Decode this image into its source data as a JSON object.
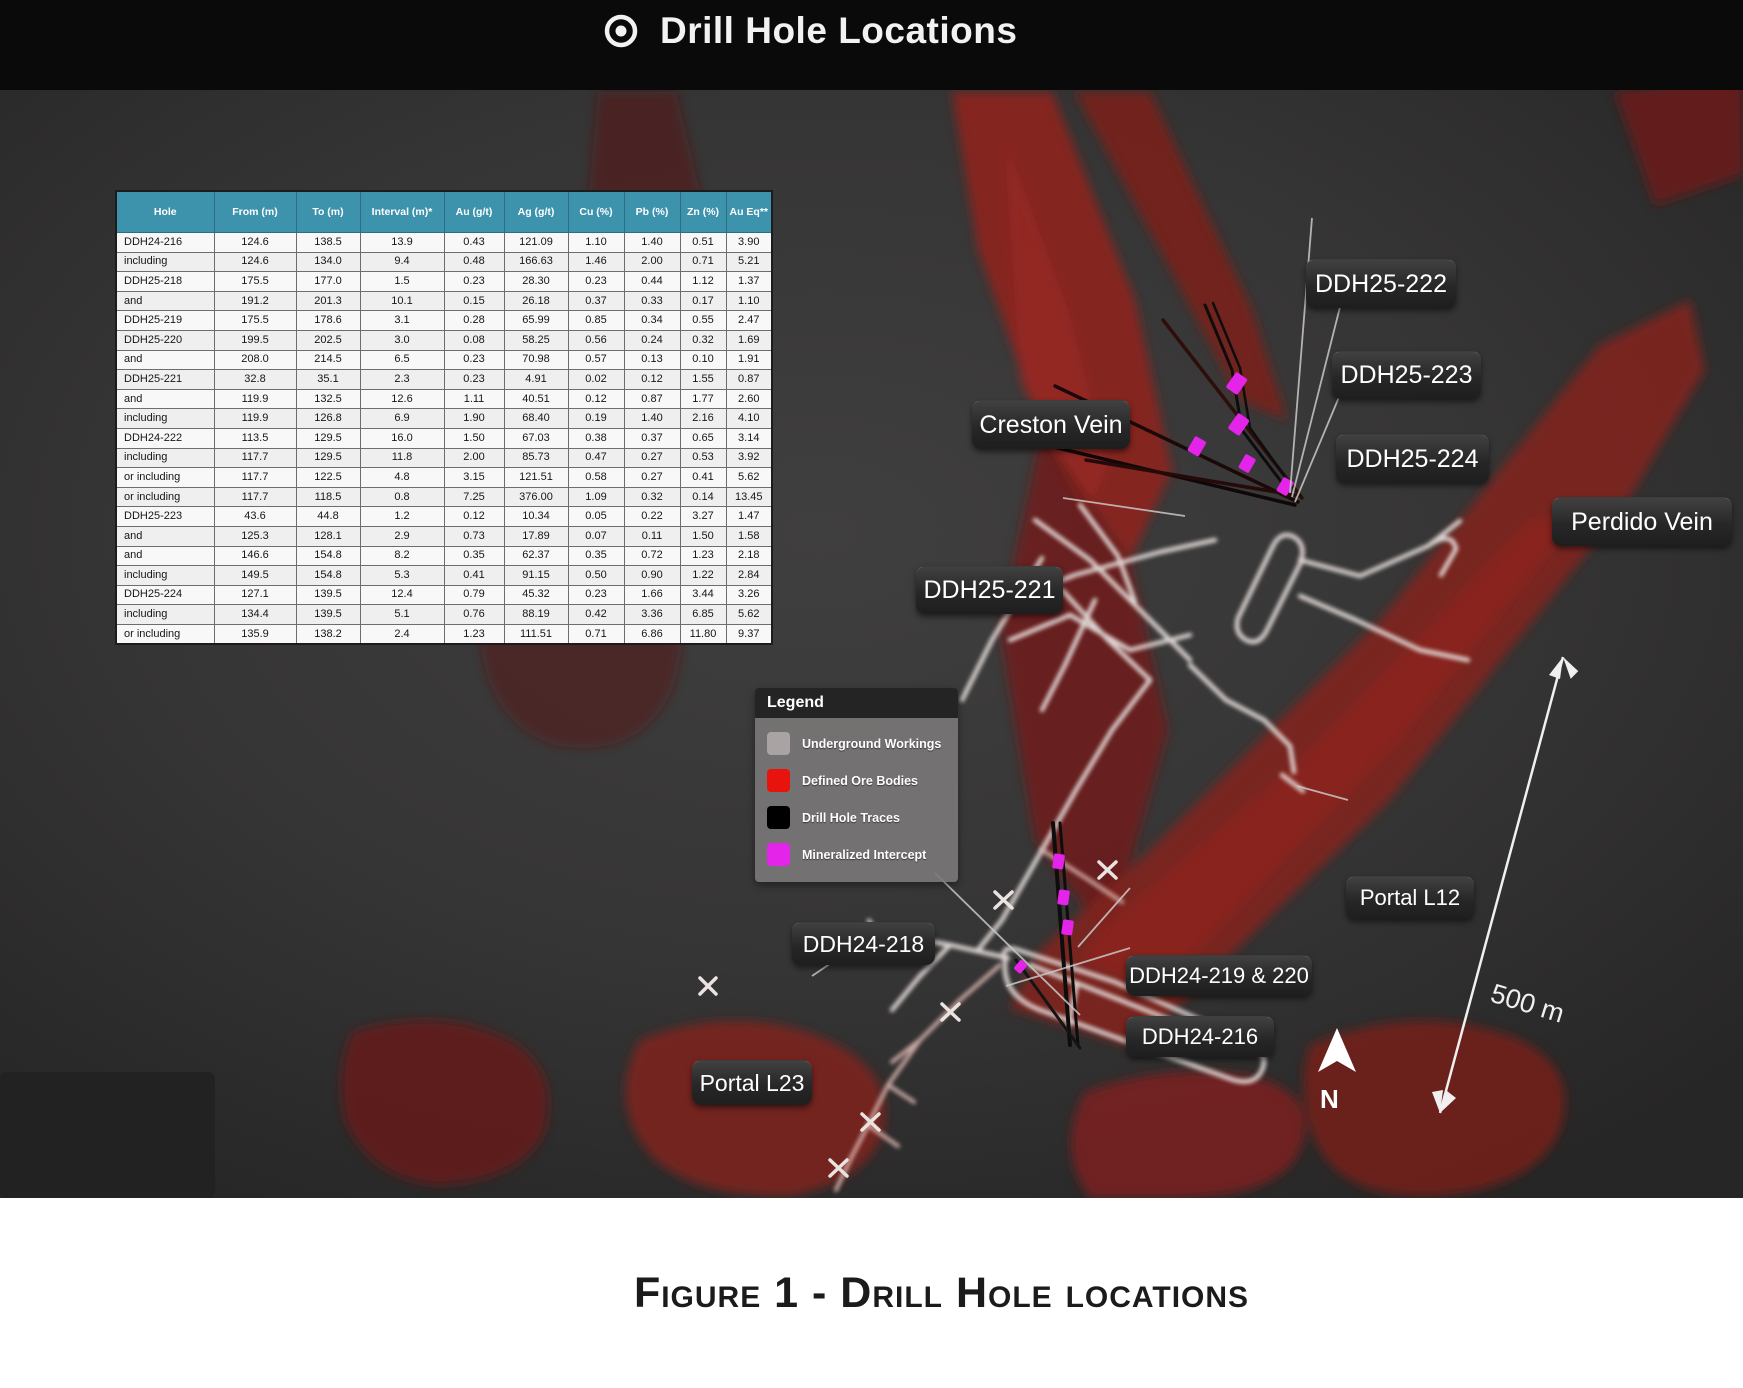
{
  "header": {
    "title": "Drill Hole Locations"
  },
  "table": {
    "columns": [
      "Hole",
      "From (m)",
      "To (m)",
      "Interval (m)*",
      "Au (g/t)",
      "Ag (g/t)",
      "Cu (%)",
      "Pb (%)",
      "Zn (%)",
      "Au Eq**"
    ],
    "rows": [
      [
        "DDH24-216",
        "124.6",
        "138.5",
        "13.9",
        "0.43",
        "121.09",
        "1.10",
        "1.40",
        "0.51",
        "3.90"
      ],
      [
        "including",
        "124.6",
        "134.0",
        "9.4",
        "0.48",
        "166.63",
        "1.46",
        "2.00",
        "0.71",
        "5.21"
      ],
      [
        "DDH25-218",
        "175.5",
        "177.0",
        "1.5",
        "0.23",
        "28.30",
        "0.23",
        "0.44",
        "1.12",
        "1.37"
      ],
      [
        "and",
        "191.2",
        "201.3",
        "10.1",
        "0.15",
        "26.18",
        "0.37",
        "0.33",
        "0.17",
        "1.10"
      ],
      [
        "DDH25-219",
        "175.5",
        "178.6",
        "3.1",
        "0.28",
        "65.99",
        "0.85",
        "0.34",
        "0.55",
        "2.47"
      ],
      [
        "DDH25-220",
        "199.5",
        "202.5",
        "3.0",
        "0.08",
        "58.25",
        "0.56",
        "0.24",
        "0.32",
        "1.69"
      ],
      [
        "and",
        "208.0",
        "214.5",
        "6.5",
        "0.23",
        "70.98",
        "0.57",
        "0.13",
        "0.10",
        "1.91"
      ],
      [
        "DDH25-221",
        "32.8",
        "35.1",
        "2.3",
        "0.23",
        "4.91",
        "0.02",
        "0.12",
        "1.55",
        "0.87"
      ],
      [
        "and",
        "119.9",
        "132.5",
        "12.6",
        "1.11",
        "40.51",
        "0.12",
        "0.87",
        "1.77",
        "2.60"
      ],
      [
        "including",
        "119.9",
        "126.8",
        "6.9",
        "1.90",
        "68.40",
        "0.19",
        "1.40",
        "2.16",
        "4.10"
      ],
      [
        "DDH24-222",
        "113.5",
        "129.5",
        "16.0",
        "1.50",
        "67.03",
        "0.38",
        "0.37",
        "0.65",
        "3.14"
      ],
      [
        "including",
        "117.7",
        "129.5",
        "11.8",
        "2.00",
        "85.73",
        "0.47",
        "0.27",
        "0.53",
        "3.92"
      ],
      [
        "or including",
        "117.7",
        "122.5",
        "4.8",
        "3.15",
        "121.51",
        "0.58",
        "0.27",
        "0.41",
        "5.62"
      ],
      [
        "or including",
        "117.7",
        "118.5",
        "0.8",
        "7.25",
        "376.00",
        "1.09",
        "0.32",
        "0.14",
        "13.45"
      ],
      [
        "DDH25-223",
        "43.6",
        "44.8",
        "1.2",
        "0.12",
        "10.34",
        "0.05",
        "0.22",
        "3.27",
        "1.47"
      ],
      [
        "and",
        "125.3",
        "128.1",
        "2.9",
        "0.73",
        "17.89",
        "0.07",
        "0.11",
        "1.50",
        "1.58"
      ],
      [
        "and",
        "146.6",
        "154.8",
        "8.2",
        "0.35",
        "62.37",
        "0.35",
        "0.72",
        "1.23",
        "2.18"
      ],
      [
        "including",
        "149.5",
        "154.8",
        "5.3",
        "0.41",
        "91.15",
        "0.50",
        "0.90",
        "1.22",
        "2.84"
      ],
      [
        "DDH25-224",
        "127.1",
        "139.5",
        "12.4",
        "0.79",
        "45.32",
        "0.23",
        "1.66",
        "3.44",
        "3.26"
      ],
      [
        "including",
        "134.4",
        "139.5",
        "5.1",
        "0.76",
        "88.19",
        "0.42",
        "3.36",
        "6.85",
        "5.62"
      ],
      [
        "or including",
        "135.9",
        "138.2",
        "2.4",
        "1.23",
        "111.51",
        "0.71",
        "6.86",
        "11.80",
        "9.37"
      ]
    ]
  },
  "legend": {
    "title": "Legend",
    "items": [
      {
        "label": "Underground Workings",
        "color": "#a9a3a3"
      },
      {
        "label": "Defined Ore Bodies",
        "color": "#e9130e"
      },
      {
        "label": "Drill Hole Traces",
        "color": "#000000"
      },
      {
        "label": "Mineralized Intercept",
        "color": "#e424e8"
      }
    ]
  },
  "map_labels": {
    "creston_vein": "Creston Vein",
    "perdido_vein": "Perdido Vein",
    "ddh25_221": "DDH25-221",
    "ddh25_222": "DDH25-222",
    "ddh25_223": "DDH25-223",
    "ddh25_224": "DDH25-224",
    "ddh24_218": "DDH24-218",
    "ddh24_219_220": "DDH24-219 & 220",
    "ddh24_216": "DDH24-216",
    "portal_l12": "Portal L12",
    "portal_l23": "Portal L23"
  },
  "scale": {
    "label": "500 m"
  },
  "compass": {
    "label": "N"
  },
  "caption": "Figure 1 - Drill Hole locations",
  "colors": {
    "table_header": "#3d92ac",
    "ore_body_red": "#8b241e",
    "workings_white": "#e6dfdc",
    "drill_trace_black": "#0d0d0d",
    "mineralized_magenta": "#e424e8",
    "viewport_bg": "#363535",
    "titlebar_bg": "#0a0a0a"
  }
}
